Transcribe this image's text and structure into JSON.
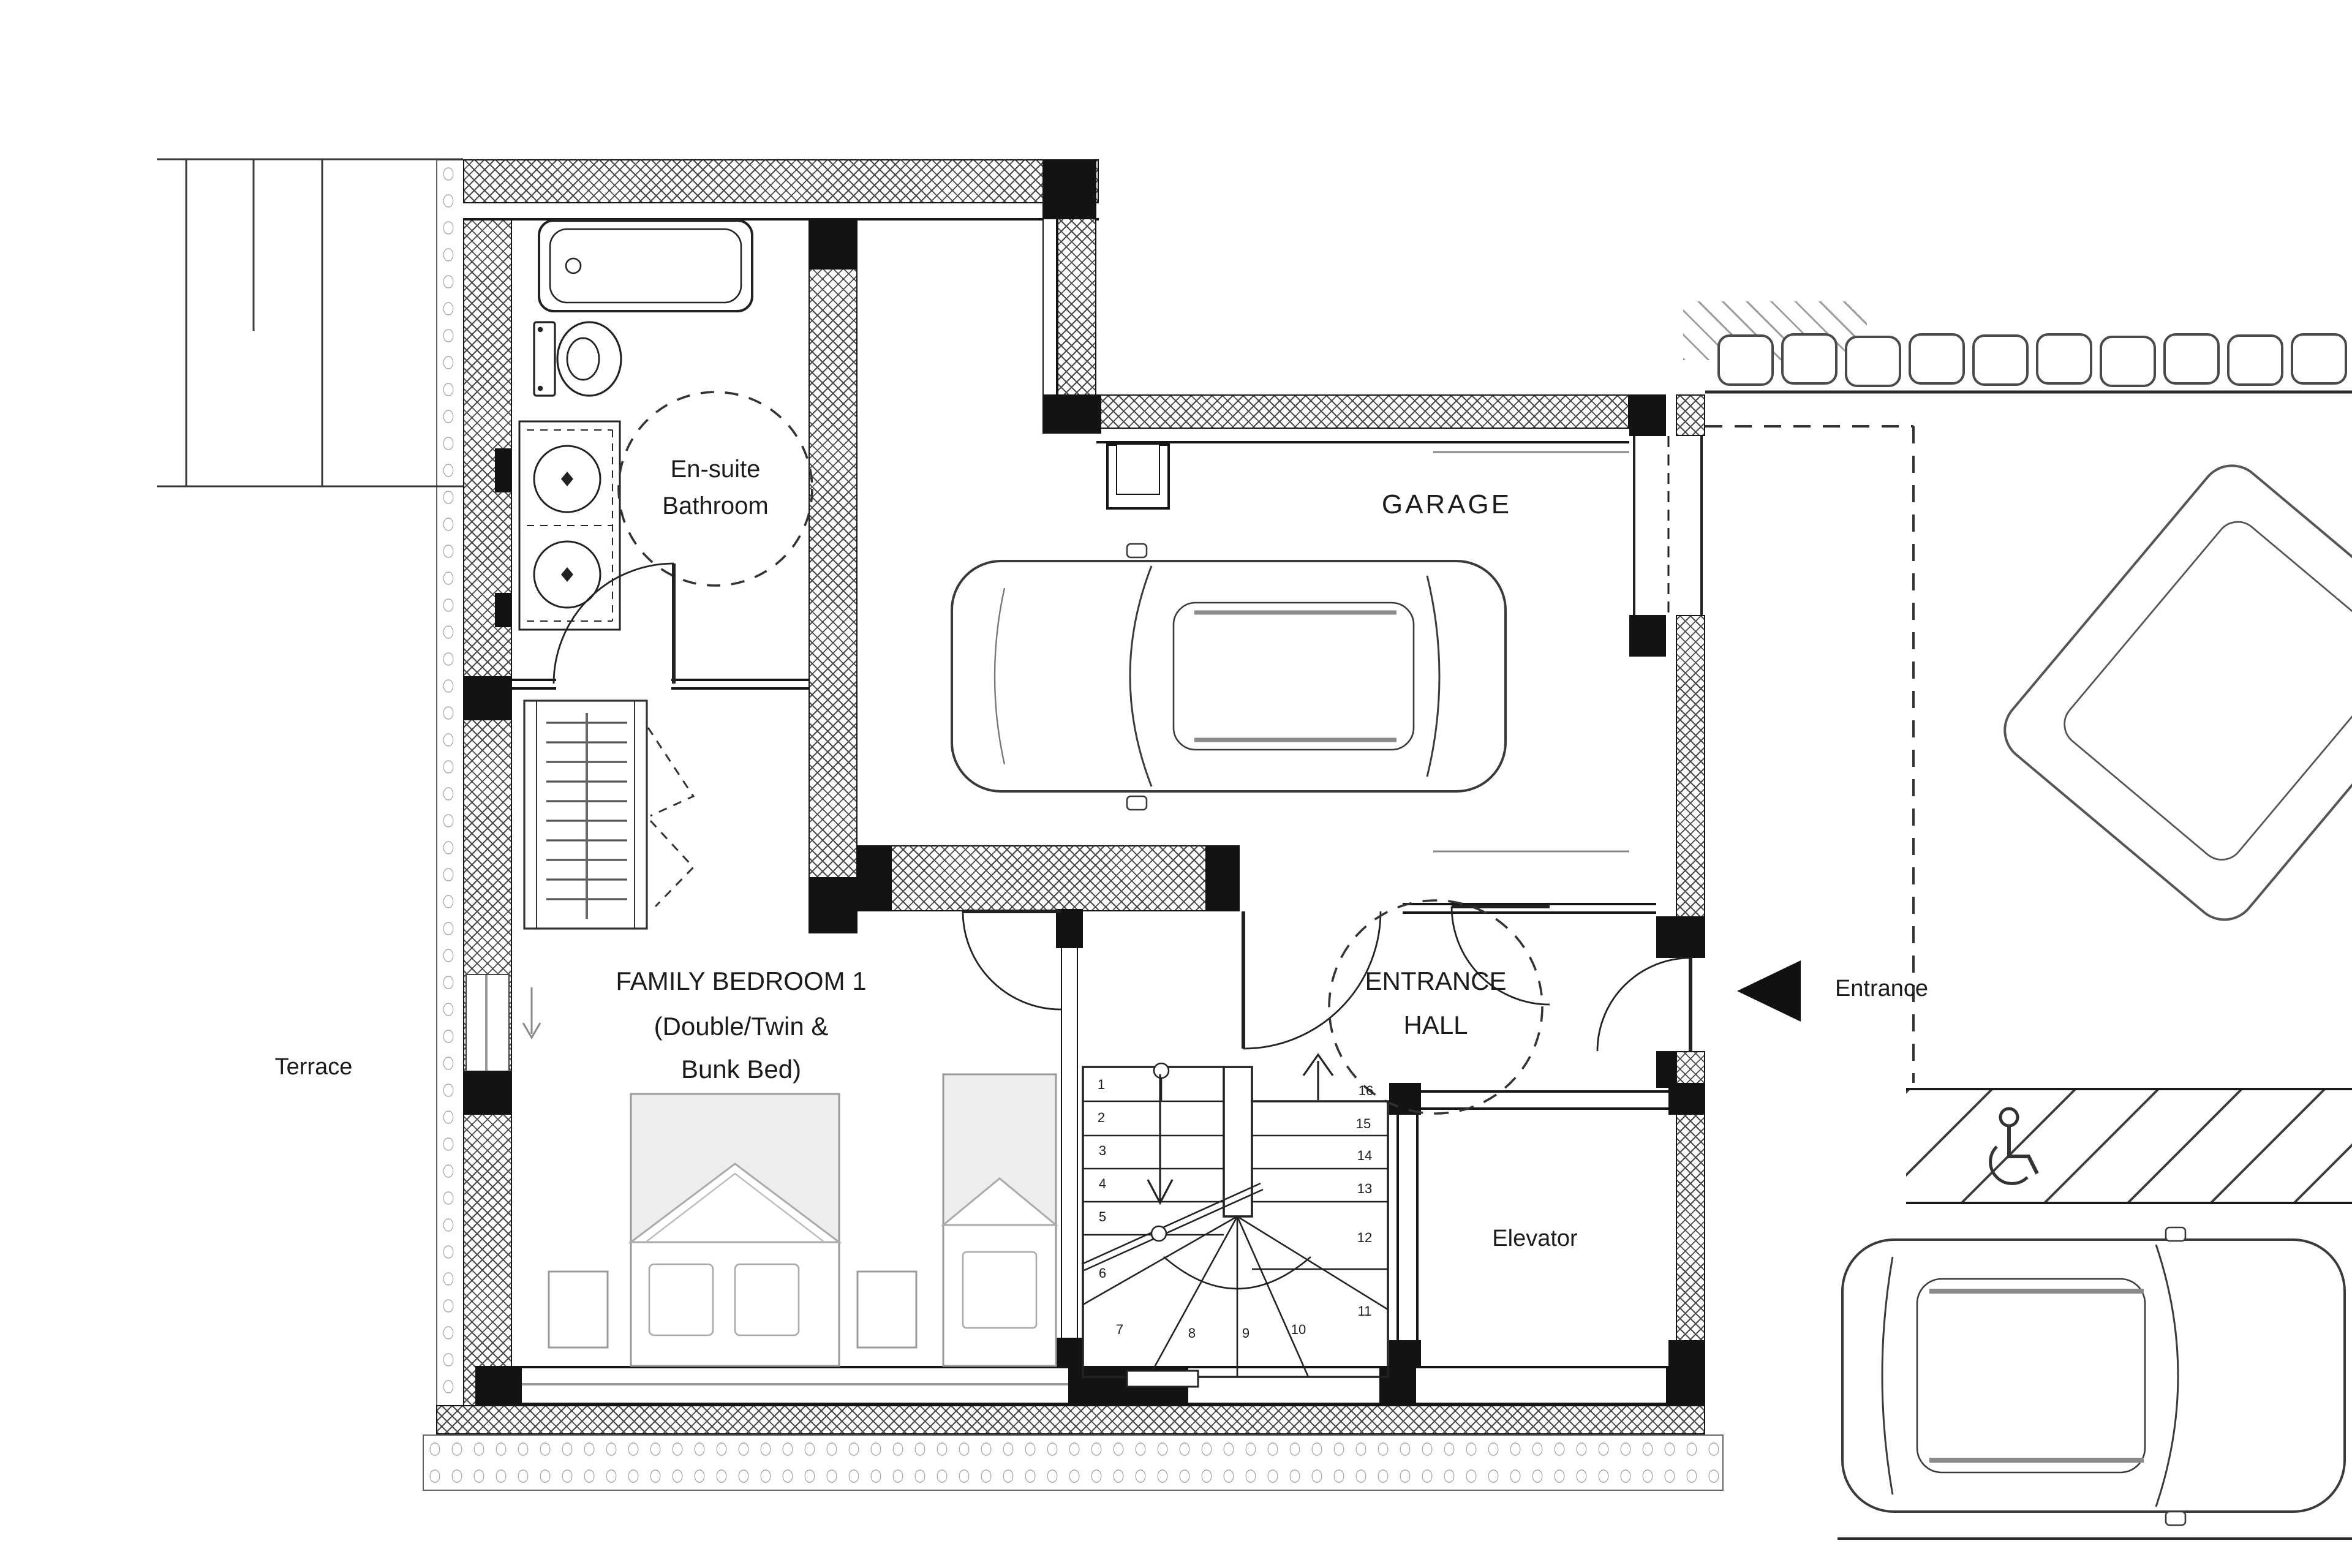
{
  "rooms": {
    "terrace": {
      "label": "Terrace"
    },
    "ensuite": {
      "line1": "En-suite",
      "line2": "Bathroom"
    },
    "garage": {
      "label": "GARAGE"
    },
    "bedroom": {
      "line1": "FAMILY BEDROOM 1",
      "line2": "(Double/Twin &",
      "line3": "Bunk Bed)"
    },
    "entrance_hall": {
      "line1": "ENTRANCE",
      "line2": "HALL"
    },
    "elevator": {
      "label": "Elevator"
    }
  },
  "annotations": {
    "entrance": "Entrance"
  },
  "stairs": {
    "steps": [
      "1",
      "2",
      "3",
      "4",
      "5",
      "6",
      "7",
      "8",
      "9",
      "10",
      "11",
      "12",
      "13",
      "14",
      "15",
      "16"
    ]
  },
  "icons": {
    "entrance_arrow": "left-pointing-solid-triangle",
    "accessible_parking": "wheelchair-symbol"
  },
  "colors": {
    "line": "#1c1c1c",
    "wall_black": "#131313",
    "bed_fill": "#ededed",
    "light_stroke": "#9a9a9a",
    "background": "#ffffff"
  }
}
